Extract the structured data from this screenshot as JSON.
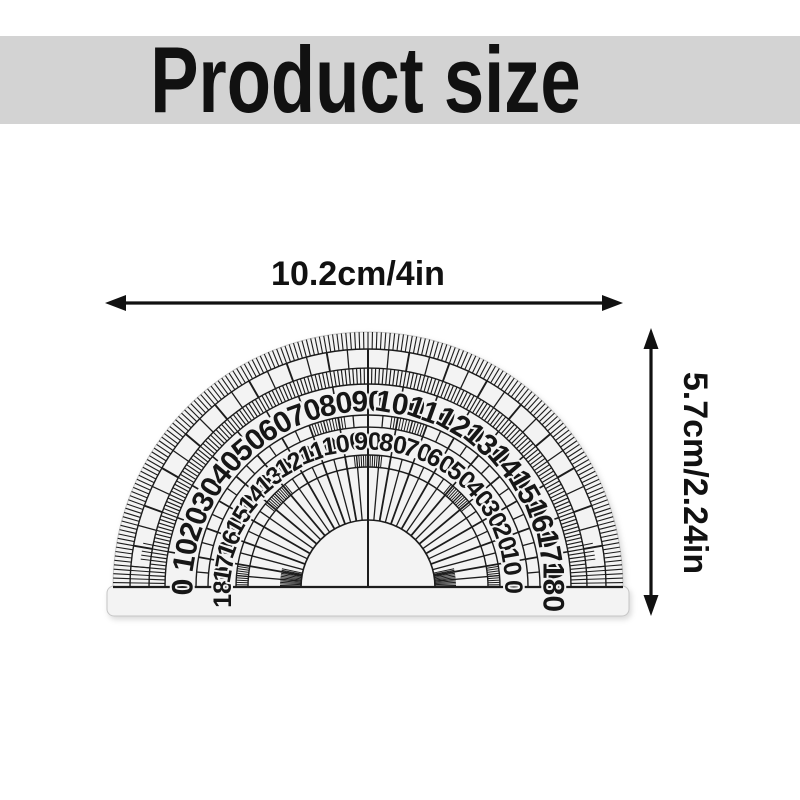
{
  "banner": {
    "title": "Product size",
    "background": "#d3d3d3",
    "text_color": "#111111"
  },
  "dimensions": {
    "width_label": "10.2cm/4in",
    "height_label": "5.7cm/2.24in",
    "arrow_color": "#111111"
  },
  "protractor": {
    "outer_scale_degrees": [
      0,
      10,
      20,
      30,
      40,
      50,
      60,
      70,
      80,
      90,
      100,
      110,
      120,
      130,
      140,
      150,
      160,
      170,
      180
    ],
    "inner_scale_degrees": [
      180,
      170,
      160,
      150,
      140,
      130,
      120,
      110,
      100,
      90,
      80,
      70,
      60,
      50,
      40,
      30,
      20,
      10,
      0
    ],
    "body_color": "#f3f3f3",
    "line_color": "#1c1c1c"
  }
}
